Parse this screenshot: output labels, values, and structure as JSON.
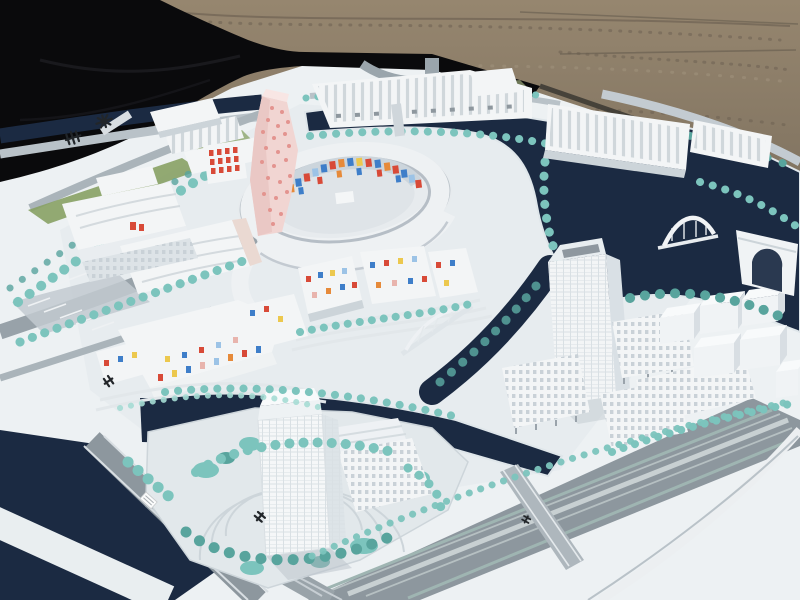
{
  "scene": {
    "type": "photograph",
    "subject": "Architectural scale model of a canal-side urban master plan",
    "setting": "White maquette on a baseboard, photographed outdoors on gravel ground with a black cloth drape at the upper left",
    "visible_text": "none (only tiny illegible black site glyphs on the baseboard)"
  },
  "labels": {
    "scene": "Architectural scale model of a canal-side urban district photographed outdoors",
    "ground": "Brown gravel ground",
    "drape": "Black cloth drape over the table edge",
    "base": "White model baseboard",
    "water": "Dark navy canals and river basin",
    "halls": "Rows of white ribbed industrial halls",
    "circle": "Circular courtyard complex with multicolored glass mosaic band",
    "pink_tower": "Twisting pink dotted landmark tower",
    "left_complex": "Large white perimeter blocks with wavy rooflines and red window grid",
    "confetti_housing": "White housing blocks with scattered multicolored window panels",
    "south_tower": "Tall translucent gridded tower on a plaza island",
    "east_towers": "East high-rise tower with slab buildings on stilts",
    "cube_cluster": "Stacked white cubic building group",
    "arch_building": "White arched gateway building",
    "arch_bridge": "White arch bridge over the basin",
    "truss_bridge": "White bowstring footbridge over the canal",
    "boulevard": "Wide grey boulevard with lane markings and curved ramp",
    "trees": "Rows of teal model trees and hedges",
    "markings": "Small black site glyphs and metro symbols on the baseboard",
    "parking": "Striped parking aprons on the west side"
  },
  "palette": {
    "gravel": "#8b7c69",
    "gravel_dark": "#6e6253",
    "cloth": "#0a0a0c",
    "base": "#edf1f3",
    "base_tint": "#dde5e9",
    "water": "#1b2a42",
    "road": "#8d979e",
    "road_light": "#c2cad0",
    "tree": "#7cc4bd",
    "tree_dark": "#58a49d",
    "tree_light": "#a5dcd4",
    "grass": "#87a164",
    "building": "#f3f5f6",
    "building_shade": "#ccd4d9",
    "building_dark": "#a7b0b8",
    "pink": "#f1d5d2",
    "pink_dot": "#e3948f",
    "red": "#d84a38",
    "blue": "#3e7ec9",
    "orange": "#e68a3a",
    "yellow": "#ecc84e",
    "sky_blue": "#9cc3e6",
    "rose": "#e8b4ad",
    "marking": "#22262a"
  }
}
